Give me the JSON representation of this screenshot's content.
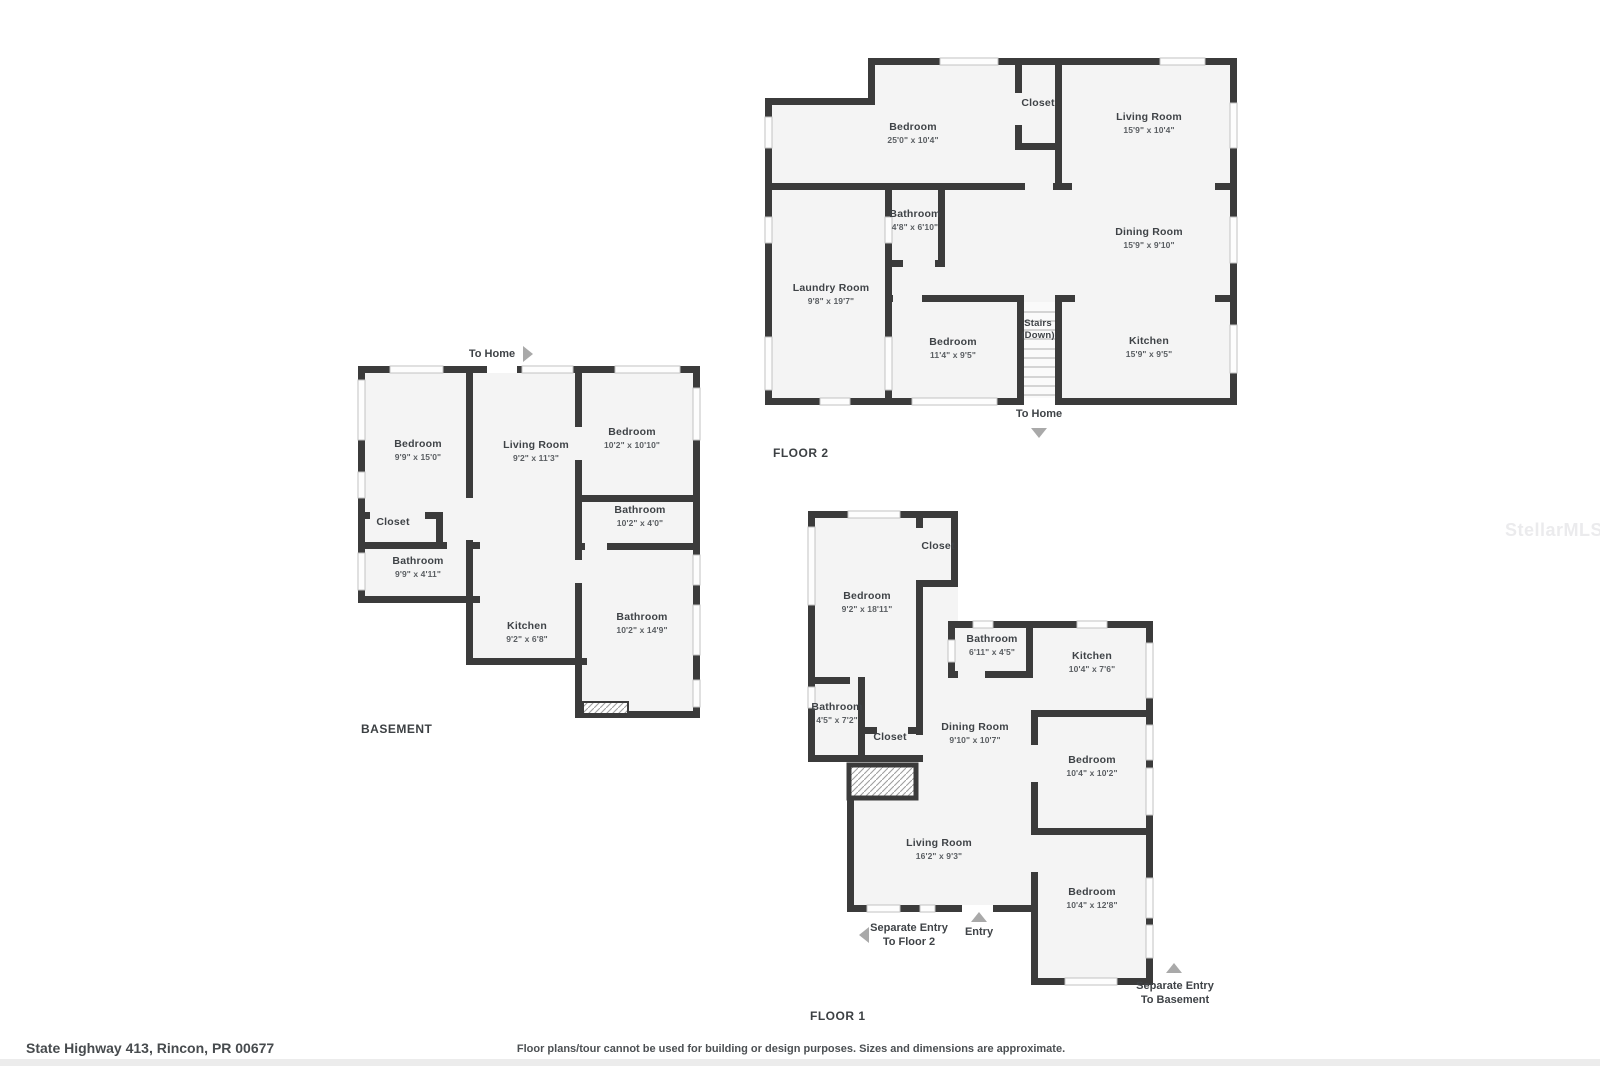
{
  "watermark": "StellarMLS",
  "footer": {
    "address": "State Highway 413, Rincon, PR 00677",
    "disclaimer": "Floor plans/tour cannot be used for building or design purposes. Sizes and dimensions are approximate."
  },
  "colors": {
    "wall": "#3b3b3b",
    "floor_fill": "#f4f4f4",
    "window_frame": "#c2c2c2",
    "arrow": "#a9a9a9",
    "text": "#3f4347"
  },
  "floors": {
    "floor2": {
      "label": "FLOOR 2",
      "to_home_label": "To Home",
      "rooms": {
        "bedroom_25": {
          "name": "Bedroom",
          "dims": "25'0\" x 10'4\""
        },
        "closet": {
          "name": "Closet"
        },
        "living": {
          "name": "Living Room",
          "dims": "15'9\" x 10'4\""
        },
        "bathroom": {
          "name": "Bathroom",
          "dims": "4'8\" x 6'10\""
        },
        "dining": {
          "name": "Dining Room",
          "dims": "15'9\" x 9'10\""
        },
        "laundry": {
          "name": "Laundry Room",
          "dims": "9'8\" x 19'7\""
        },
        "stairs": {
          "name": "Stairs",
          "dims": "(Down)"
        },
        "bedroom_11": {
          "name": "Bedroom",
          "dims": "11'4\" x 9'5\""
        },
        "kitchen": {
          "name": "Kitchen",
          "dims": "15'9\" x 9'5\""
        }
      }
    },
    "basement": {
      "label": "BASEMENT",
      "to_home_label": "To Home",
      "rooms": {
        "bedroom_9915": {
          "name": "Bedroom",
          "dims": "9'9\" x 15'0\""
        },
        "living": {
          "name": "Living Room",
          "dims": "9'2\" x 11'3\""
        },
        "bedroom_1021010": {
          "name": "Bedroom",
          "dims": "10'2\" x 10'10\""
        },
        "closet": {
          "name": "Closet"
        },
        "bathroom_10240": {
          "name": "Bathroom",
          "dims": "10'2\" x 4'0\""
        },
        "bathroom_99411": {
          "name": "Bathroom",
          "dims": "9'9\" x 4'11\""
        },
        "kitchen": {
          "name": "Kitchen",
          "dims": "9'2\" x 6'8\""
        },
        "bathroom_102149": {
          "name": "Bathroom",
          "dims": "10'2\" x 14'9\""
        }
      }
    },
    "floor1": {
      "label": "FLOOR 1",
      "entry_label": "Entry",
      "separate_entry_floor2": {
        "line1": "Separate Entry",
        "line2": "To Floor 2"
      },
      "separate_entry_basement": {
        "line1": "Separate Entry",
        "line2": "To Basement"
      },
      "rooms": {
        "bedroom_921811": {
          "name": "Bedroom",
          "dims": "9'2\" x 18'11\""
        },
        "closet_top": {
          "name": "Closet"
        },
        "bathroom_61145": {
          "name": "Bathroom",
          "dims": "6'11\" x 4'5\""
        },
        "kitchen": {
          "name": "Kitchen",
          "dims": "10'4\" x 7'6\""
        },
        "bathroom_4572": {
          "name": "Bathroom",
          "dims": "4'5\" x 7'2\""
        },
        "closet_mid": {
          "name": "Closet"
        },
        "dining": {
          "name": "Dining Room",
          "dims": "9'10\" x 10'7\""
        },
        "bedroom_104102": {
          "name": "Bedroom",
          "dims": "10'4\" x 10'2\""
        },
        "living": {
          "name": "Living Room",
          "dims": "16'2\" x 9'3\""
        },
        "bedroom_104128": {
          "name": "Bedroom",
          "dims": "10'4\" x 12'8\""
        }
      }
    }
  }
}
